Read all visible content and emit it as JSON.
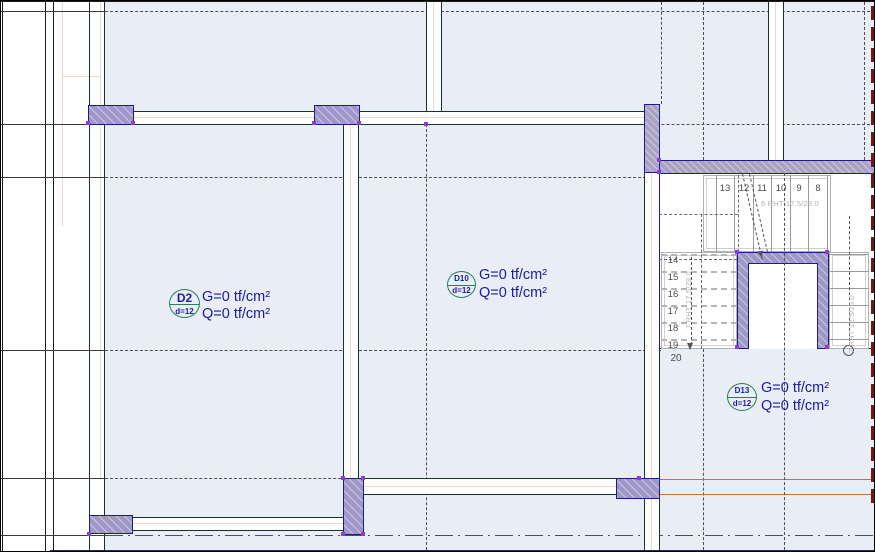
{
  "drawing": {
    "type": "structural-floor-plan",
    "slab_labels": [
      {
        "tag": "D2",
        "thickness": "d=12",
        "g_load": "G=0 tf/cm²",
        "q_load": "Q=0 tf/cm²"
      },
      {
        "tag": "D10",
        "thickness": "d=12",
        "g_load": "G=0 tf/cm²",
        "q_load": "Q=0 tf/cm²"
      },
      {
        "tag": "D13",
        "thickness": "d=12",
        "g_load": "G=0 tf/cm²",
        "q_load": "Q=0 tf/cm²"
      }
    ],
    "stair": {
      "upper_flight_numbers": [
        "13",
        "12",
        "11",
        "10",
        "9",
        "8"
      ],
      "upper_flight_label": "6 RHT 17.5/28.0",
      "left_flight_numbers": [
        "14",
        "15",
        "16",
        "17",
        "18",
        "19"
      ],
      "left_flight_label": "7 RHT 17.5/28.0",
      "right_flight_label": "7 RHT 12.5/25.0",
      "landing_step_number": "20"
    },
    "colors": {
      "slab_fill": "#e9eef6",
      "wall_edge": "#15332a",
      "column_fill": "#9d97cb",
      "column_border": "#1b1b8e",
      "label_circle": "#2a7d52",
      "label_text": "#1b1b9e",
      "grid_line": "#4f4f52",
      "accent_orange": "#c4733b",
      "accent_red": "#77150f",
      "bottom_strip": "#252a5e"
    }
  }
}
